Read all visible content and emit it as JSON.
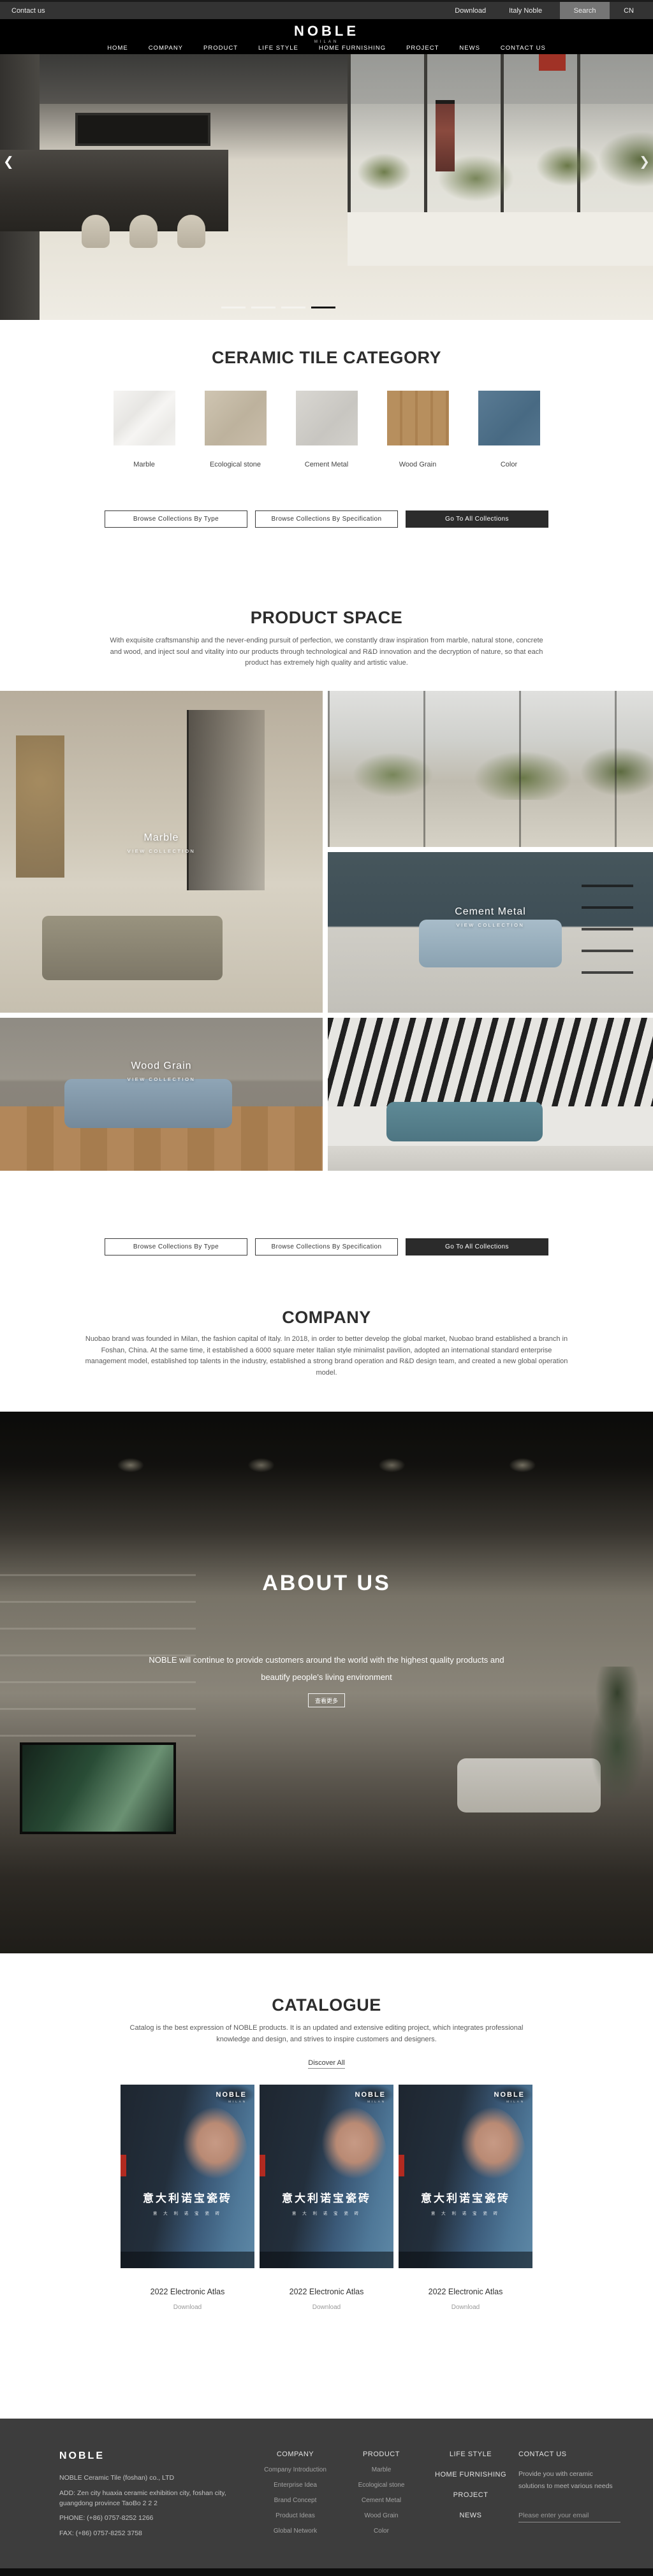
{
  "topbar": {
    "contact_us": "Contact us",
    "download": "Download",
    "italy_noble": "Italy Noble",
    "search": "Search",
    "language": "CN"
  },
  "header": {
    "logo": "NOBLE",
    "logo_subtitle": "MILAN",
    "nav": [
      "HOME",
      "COMPANY",
      "PRODUCT",
      "LIFE STYLE",
      "HOME FURNISHING",
      "PROJECT",
      "NEWS",
      "CONTACT US"
    ]
  },
  "hero": {
    "prev_arrow": "❮",
    "next_arrow": "❯"
  },
  "browse_buttons": {
    "by_type": "Browse Collections By Type",
    "by_spec": "Browse Collections By Specification",
    "all": "Go To All Collections"
  },
  "category": {
    "title": "CERAMIC TILE CATEGORY",
    "tiles": [
      {
        "label": "Marble"
      },
      {
        "label": "Ecological stone"
      },
      {
        "label": "Cement Metal"
      },
      {
        "label": "Wood Grain"
      },
      {
        "label": "Color"
      }
    ]
  },
  "product_space": {
    "title": "PRODUCT SPACE",
    "description": "With exquisite craftsmanship and the never-ending pursuit of perfection, we constantly draw inspiration from marble, natural stone, concrete and wood, and inject soul and vitality into our products through technological and R&D innovation and the decryption of nature, so that each product has extremely high quality and artistic value.",
    "cards": [
      {
        "name": "Marble",
        "cta": "VIEW COLLECTION"
      },
      {
        "name": "Cement Metal",
        "cta": "VIEW COLLECTION"
      },
      {
        "name": "Wood Grain",
        "cta": "VIEW COLLECTION"
      }
    ]
  },
  "company": {
    "title": "COMPANY",
    "description": "Nuobao brand was founded in Milan, the fashion capital of Italy. In 2018, in order to better develop the global market, Nuobao brand established a branch in Foshan, China. At the same time, it established a 6000 square meter Italian style minimalist pavilion, adopted an international standard enterprise management model, established top talents in the industry, established a strong brand operation and R&D design team, and created a new global operation model."
  },
  "about": {
    "title": "ABOUT US",
    "description": "NOBLE will continue to provide customers around the world with the highest quality products and beautify people's living environment",
    "more_button": "查看更多"
  },
  "catalogue": {
    "title": "CATALOGUE",
    "description": "Catalog is the best expression of NOBLE products. It is an updated and extensive editing project, which integrates professional knowledge and design, and strives to inspire customers and designers.",
    "discover_all": "Discover All",
    "cover": {
      "brand": "NOBLE",
      "brand_sub": "MILAN",
      "cn_title": "意大利诺宝瓷砖",
      "cn_small": "意 大 利 诺 宝 瓷 砖"
    },
    "items": [
      {
        "title": "2022 Electronic Atlas",
        "download": "Download"
      },
      {
        "title": "2022 Electronic Atlas",
        "download": "Download"
      },
      {
        "title": "2022 Electronic Atlas",
        "download": "Download"
      }
    ]
  },
  "footer": {
    "logo": "NOBLE",
    "company_name": "NOBLE Ceramic Tile (foshan) co., LTD",
    "address": "ADD:  Zen city huaxia ceramic exhibition city, foshan city, guangdong province TaoBo 2 2 2",
    "phone": "PHONE:   (+86)  0757-8252 1266",
    "fax": "FAX:   (+86)  0757-8252 3758",
    "company_col": {
      "title": "COMPANY",
      "links": [
        "Company Introduction",
        "Enterprise Idea",
        "Brand Concept",
        "Product Ideas",
        "Global Network"
      ]
    },
    "product_col": {
      "title": "PRODUCT",
      "links": [
        "Marble",
        "Ecological stone",
        "Cement Metal",
        "Wood Grain",
        "Color"
      ]
    },
    "nav_col": [
      "LIFE STYLE",
      "HOME FURNISHING",
      "PROJECT",
      "NEWS"
    ],
    "contact_col": {
      "title": "CONTACT US",
      "text": "Provide you with ceramic solutions to meet various needs",
      "email_placeholder": "Please enter your email"
    }
  }
}
